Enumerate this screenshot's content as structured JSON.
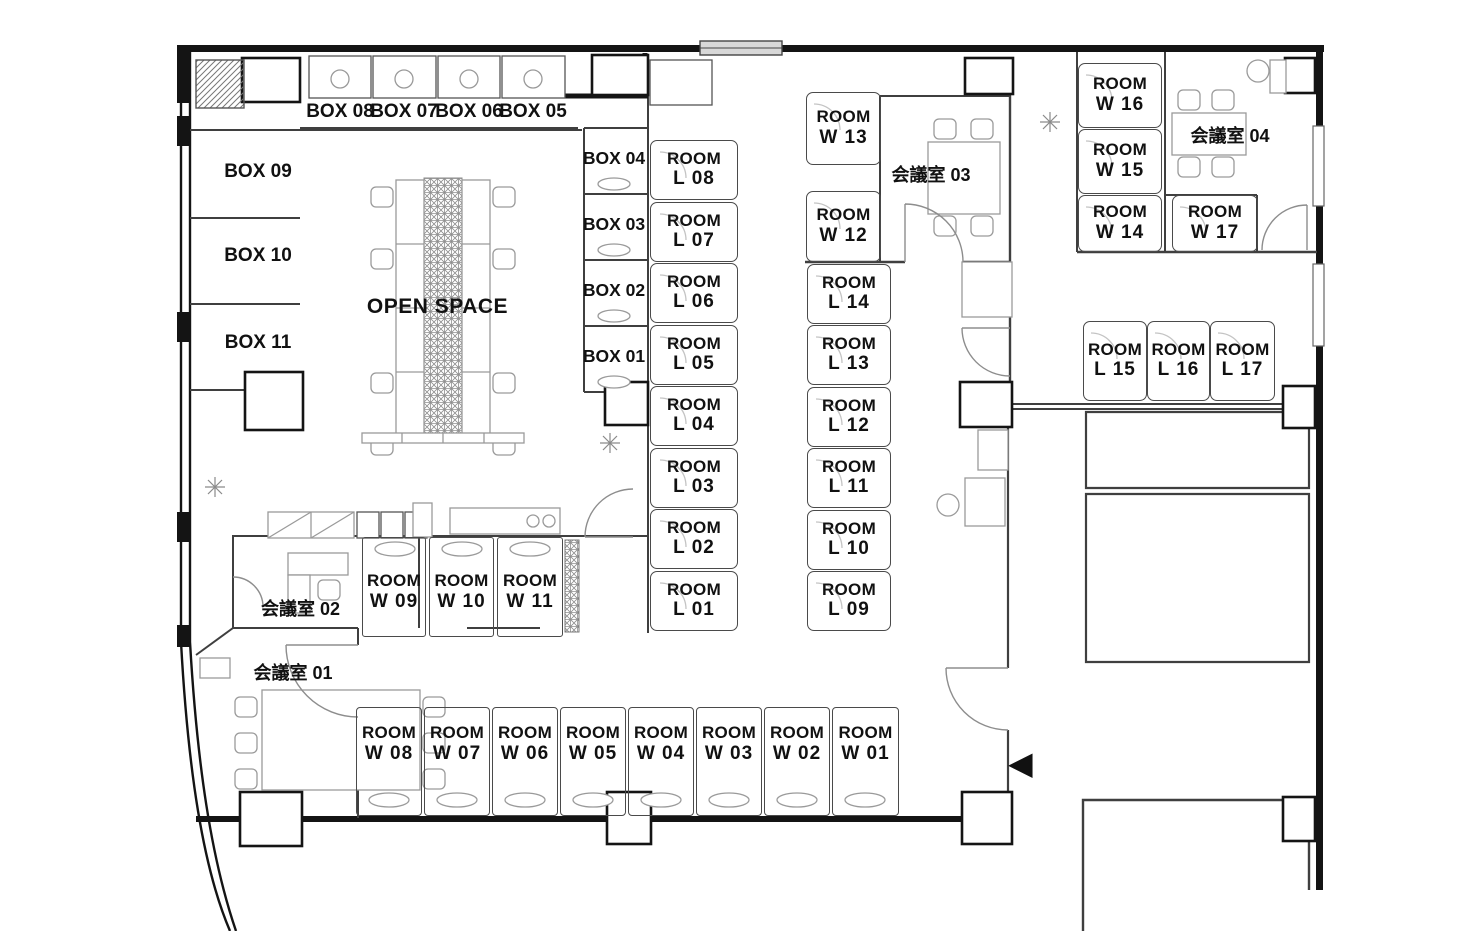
{
  "plan": {
    "room_word": "ROOM",
    "open_space": "OPEN SPACE",
    "icons": {
      "entrance": "◀"
    },
    "colors": {
      "wall": "#141414",
      "partition": "#3f3f3f",
      "furniture": "#9a9a9a",
      "background": "#ffffff"
    },
    "l_left": [
      "L 08",
      "L 07",
      "L 06",
      "L 05",
      "L 04",
      "L 03",
      "L 02",
      "L 01"
    ],
    "l_right": [
      "L 14",
      "L 13",
      "L 12",
      "L 11",
      "L 10",
      "L 09"
    ],
    "l_row": [
      "L 15",
      "L 16",
      "L 17"
    ],
    "w_mid": [
      "W 13",
      "W 12"
    ],
    "w_topright": [
      "W 16",
      "W 15",
      "W 14",
      "W 17"
    ],
    "w_small": [
      "W 09",
      "W 10",
      "W 11"
    ],
    "w_bottom": [
      "W 08",
      "W 07",
      "W 06",
      "W 05",
      "W 04",
      "W 03",
      "W 02",
      "W 01"
    ],
    "box_top": [
      "BOX 08",
      "BOX 07",
      "BOX 06",
      "BOX 05"
    ],
    "box_left": [
      "BOX 09",
      "BOX 10",
      "BOX 11"
    ],
    "box_mid": [
      "BOX 04",
      "BOX 03",
      "BOX 02",
      "BOX 01"
    ],
    "meeting": [
      "会議室 01",
      "会議室 02",
      "会議室 03",
      "会議室 04"
    ]
  }
}
